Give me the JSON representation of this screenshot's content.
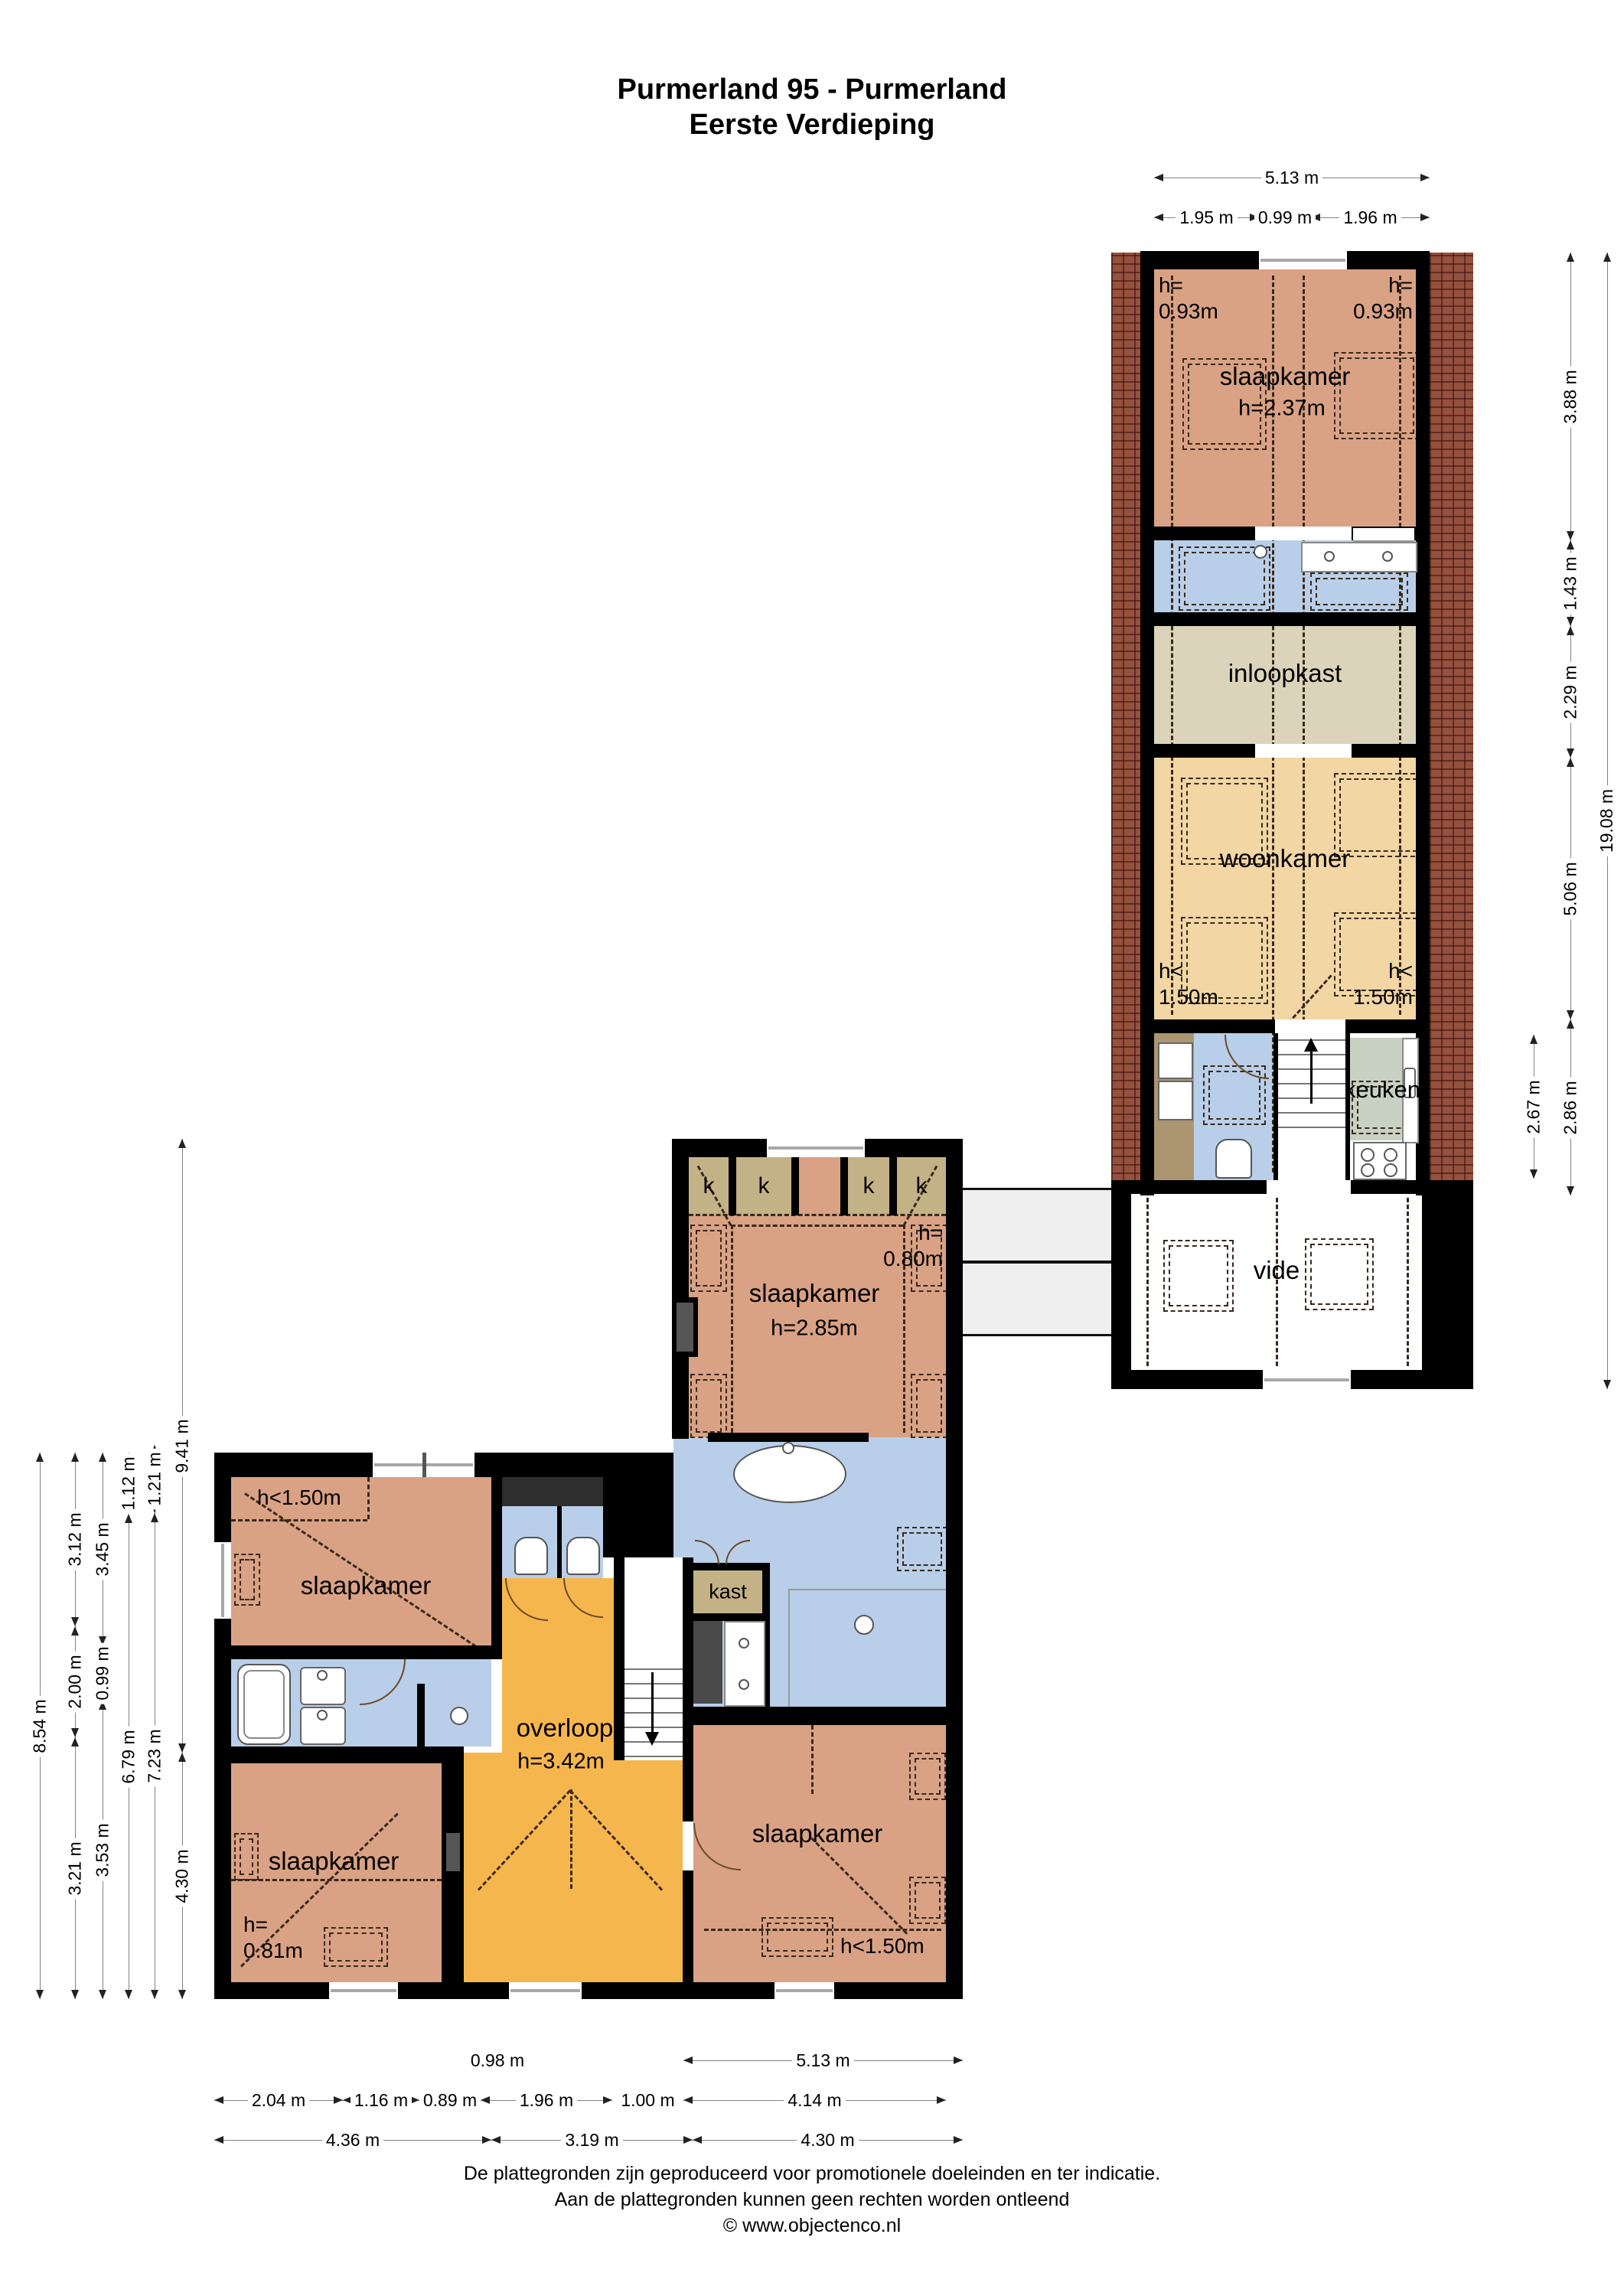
{
  "title": {
    "line1": "Purmerland 95 - Purmerland",
    "line2": "Eerste Verdieping"
  },
  "rooms": {
    "slaapkamer_attic": {
      "name": "slaapkamer",
      "height": "h=2.37m"
    },
    "inloopkast": {
      "name": "inloopkast"
    },
    "woonkamer": {
      "name": "woonkamer"
    },
    "keuken": {
      "name": "keuken"
    },
    "vide": {
      "name": "vide"
    },
    "slaapkamer_master": {
      "name": "slaapkamer",
      "height": "h=2.85m"
    },
    "slaapkamer_west": {
      "name": "slaapkamer"
    },
    "slaapkamer_southwest": {
      "name": "slaapkamer"
    },
    "slaapkamer_southeast": {
      "name": "slaapkamer"
    },
    "overloop": {
      "name": "overloop",
      "height": "h=3.42m"
    },
    "kast": {
      "name": "kast"
    },
    "closet_k": "k"
  },
  "height_notes": {
    "attic_left": {
      "l1": "h=",
      "l2": "0.93m"
    },
    "attic_right": {
      "l1": "h=",
      "l2": "0.93m"
    },
    "woonkamer_left": {
      "l1": "h<",
      "l2": "1.50m"
    },
    "woonkamer_right": {
      "l1": "h<",
      "l2": "1.50m"
    },
    "master_dormer": {
      "l1": "h=",
      "l2": "0.80m"
    },
    "west": {
      "l1": "h<1.50m"
    },
    "southwest": {
      "l1": "h=",
      "l2": "0.81m"
    },
    "southeast": {
      "l1": "h<1.50m"
    }
  },
  "dimensions": {
    "top": [
      "5.13 m",
      "1.95 m",
      "0.99 m",
      "1.96 m"
    ],
    "right": [
      "3.88 m",
      "1.43 m",
      "2.29 m",
      "5.06 m",
      "2.86 m",
      "2.67 m",
      "19.08 m"
    ],
    "left": [
      "8.54 m",
      "3.12 m",
      "2.00 m",
      "3.21 m",
      "3.45 m",
      "0.99 m",
      "3.53 m",
      "1.12 m",
      "6.79 m",
      "1.21 m",
      "7.23 m",
      "9.41 m",
      "4.30 m"
    ],
    "bottom": [
      "0.98 m",
      "5.13 m",
      "2.04 m",
      "1.16 m",
      "0.89 m",
      "1.96 m",
      "1.00 m",
      "4.14 m",
      "4.36 m",
      "3.19 m",
      "4.30 m"
    ]
  },
  "footer": {
    "line1": "De plattegronden zijn geproduceerd voor promotionele doeleinden en ter indicatie.",
    "line2": "Aan de plattegronden kunnen geen rechten worden ontleend",
    "line3": "© www.objectenco.nl"
  },
  "colors": {
    "bedroom_salmon": "#d9a284",
    "living_tan": "#f2d6a4",
    "closet_beige": "#dcd4ba",
    "bathroom_blue": "#b9cfe9",
    "hall_orange": "#f6b64e",
    "cabinet_tan": "#c4b287",
    "kitchen_green": "#c8d1c2",
    "roof_brick": "#96503e",
    "wall_black": "#000000",
    "connector_gray": "#efefef"
  }
}
